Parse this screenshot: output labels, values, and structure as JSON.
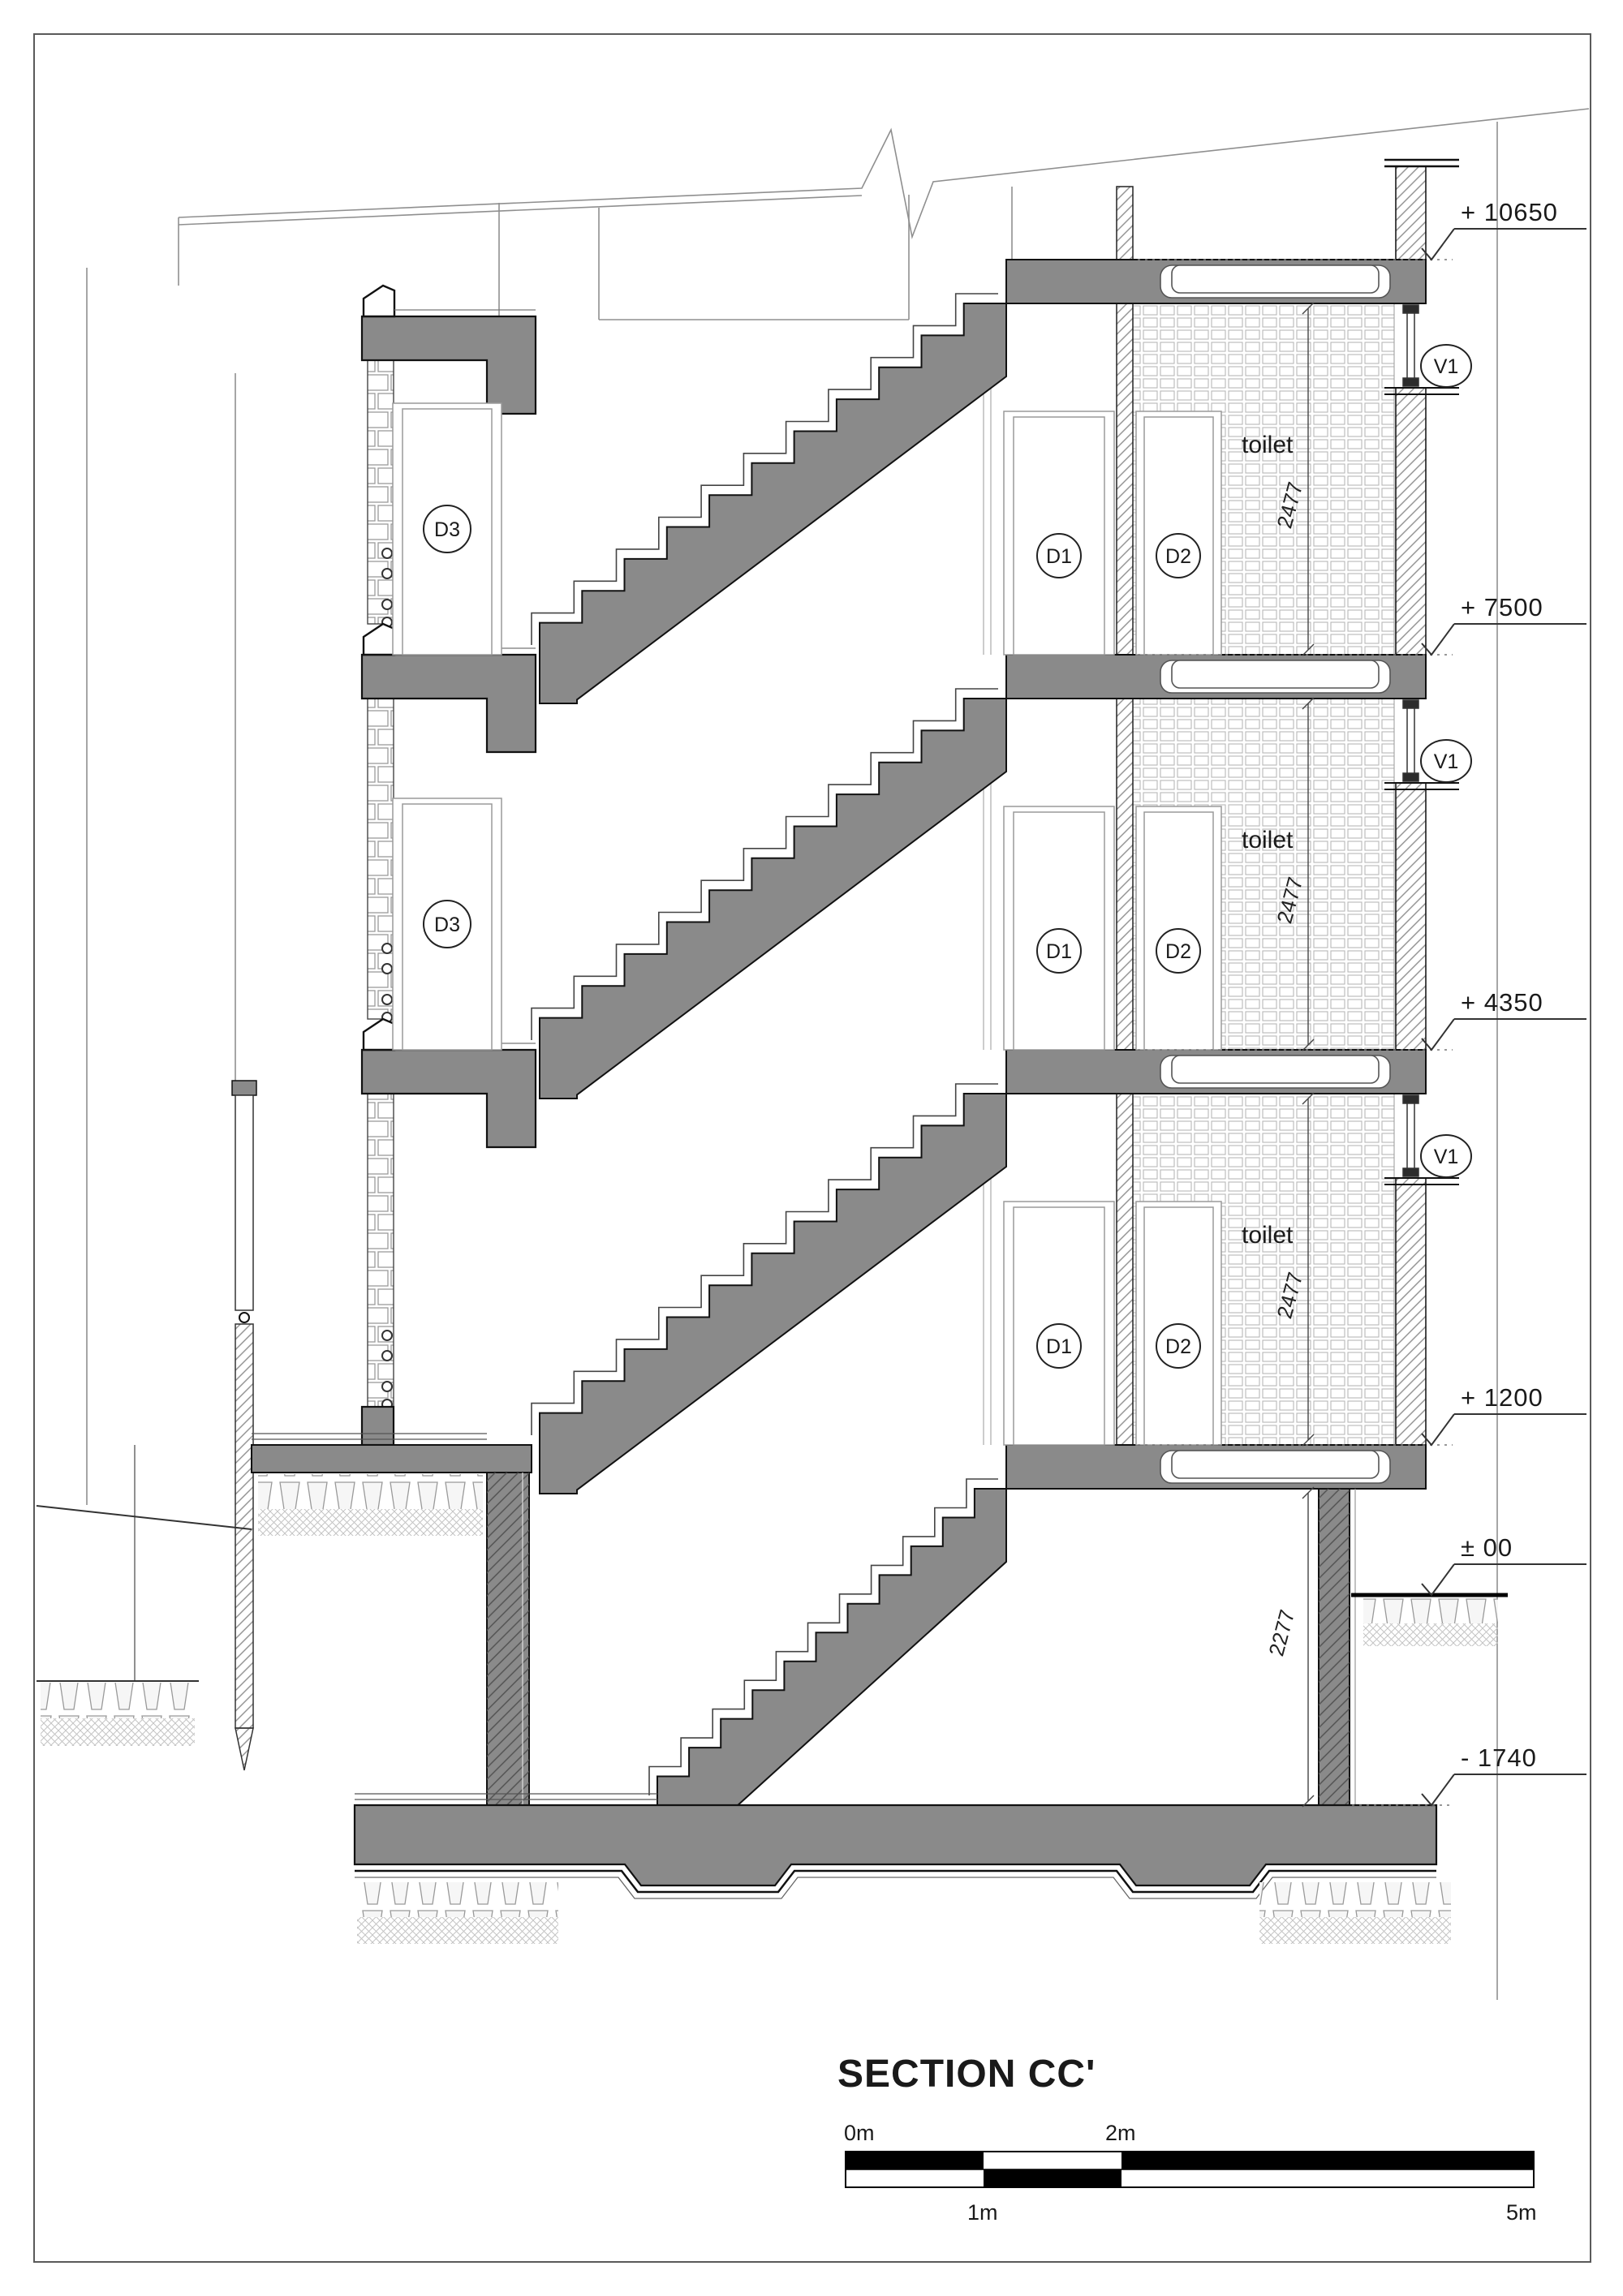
{
  "drawing": {
    "title": "SECTION CC'",
    "levels": [
      {
        "label": "+ 10650"
      },
      {
        "label": "+ 7500"
      },
      {
        "label": "+ 4350"
      },
      {
        "label": "+ 1200"
      },
      {
        "label": "± 00"
      },
      {
        "label": "- 1740"
      }
    ],
    "rooms": {
      "toilet": "toilet"
    },
    "tags": {
      "door1": "D1",
      "door2": "D2",
      "door3": "D3",
      "vent": "V1"
    },
    "dimensions": {
      "toilet_height": "2477",
      "basement_height": "2277"
    },
    "scalebar": {
      "m0": "0m",
      "m1": "1m",
      "m2": "2m",
      "m5": "5m"
    },
    "colors": {
      "slab_gray": "#8a8a8a",
      "line": "#1a1a1a",
      "bar_black": "#000000"
    }
  }
}
